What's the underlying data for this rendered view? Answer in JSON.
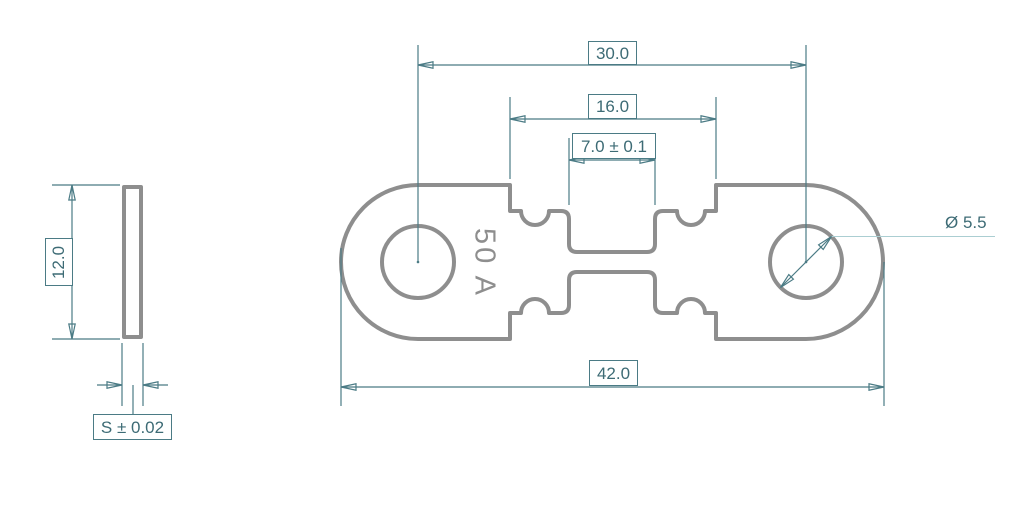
{
  "drawing": {
    "part_marking": "50 A",
    "top_view": {
      "hole_pitch": "30.0",
      "recess_width": "16.0",
      "element_width": "7.0 ± 0.1",
      "overall_length": "42.0",
      "hole_diameter": "Ø 5.5"
    },
    "side_view": {
      "height": "12.0",
      "thickness": "S ± 0.02"
    },
    "colors": {
      "outline_gray": "#8e8e8e",
      "dimension_teal": "#4b7b85",
      "dimension_text": "#3d6b75",
      "leader_light": "#abced2",
      "background": "#ffffff"
    }
  }
}
